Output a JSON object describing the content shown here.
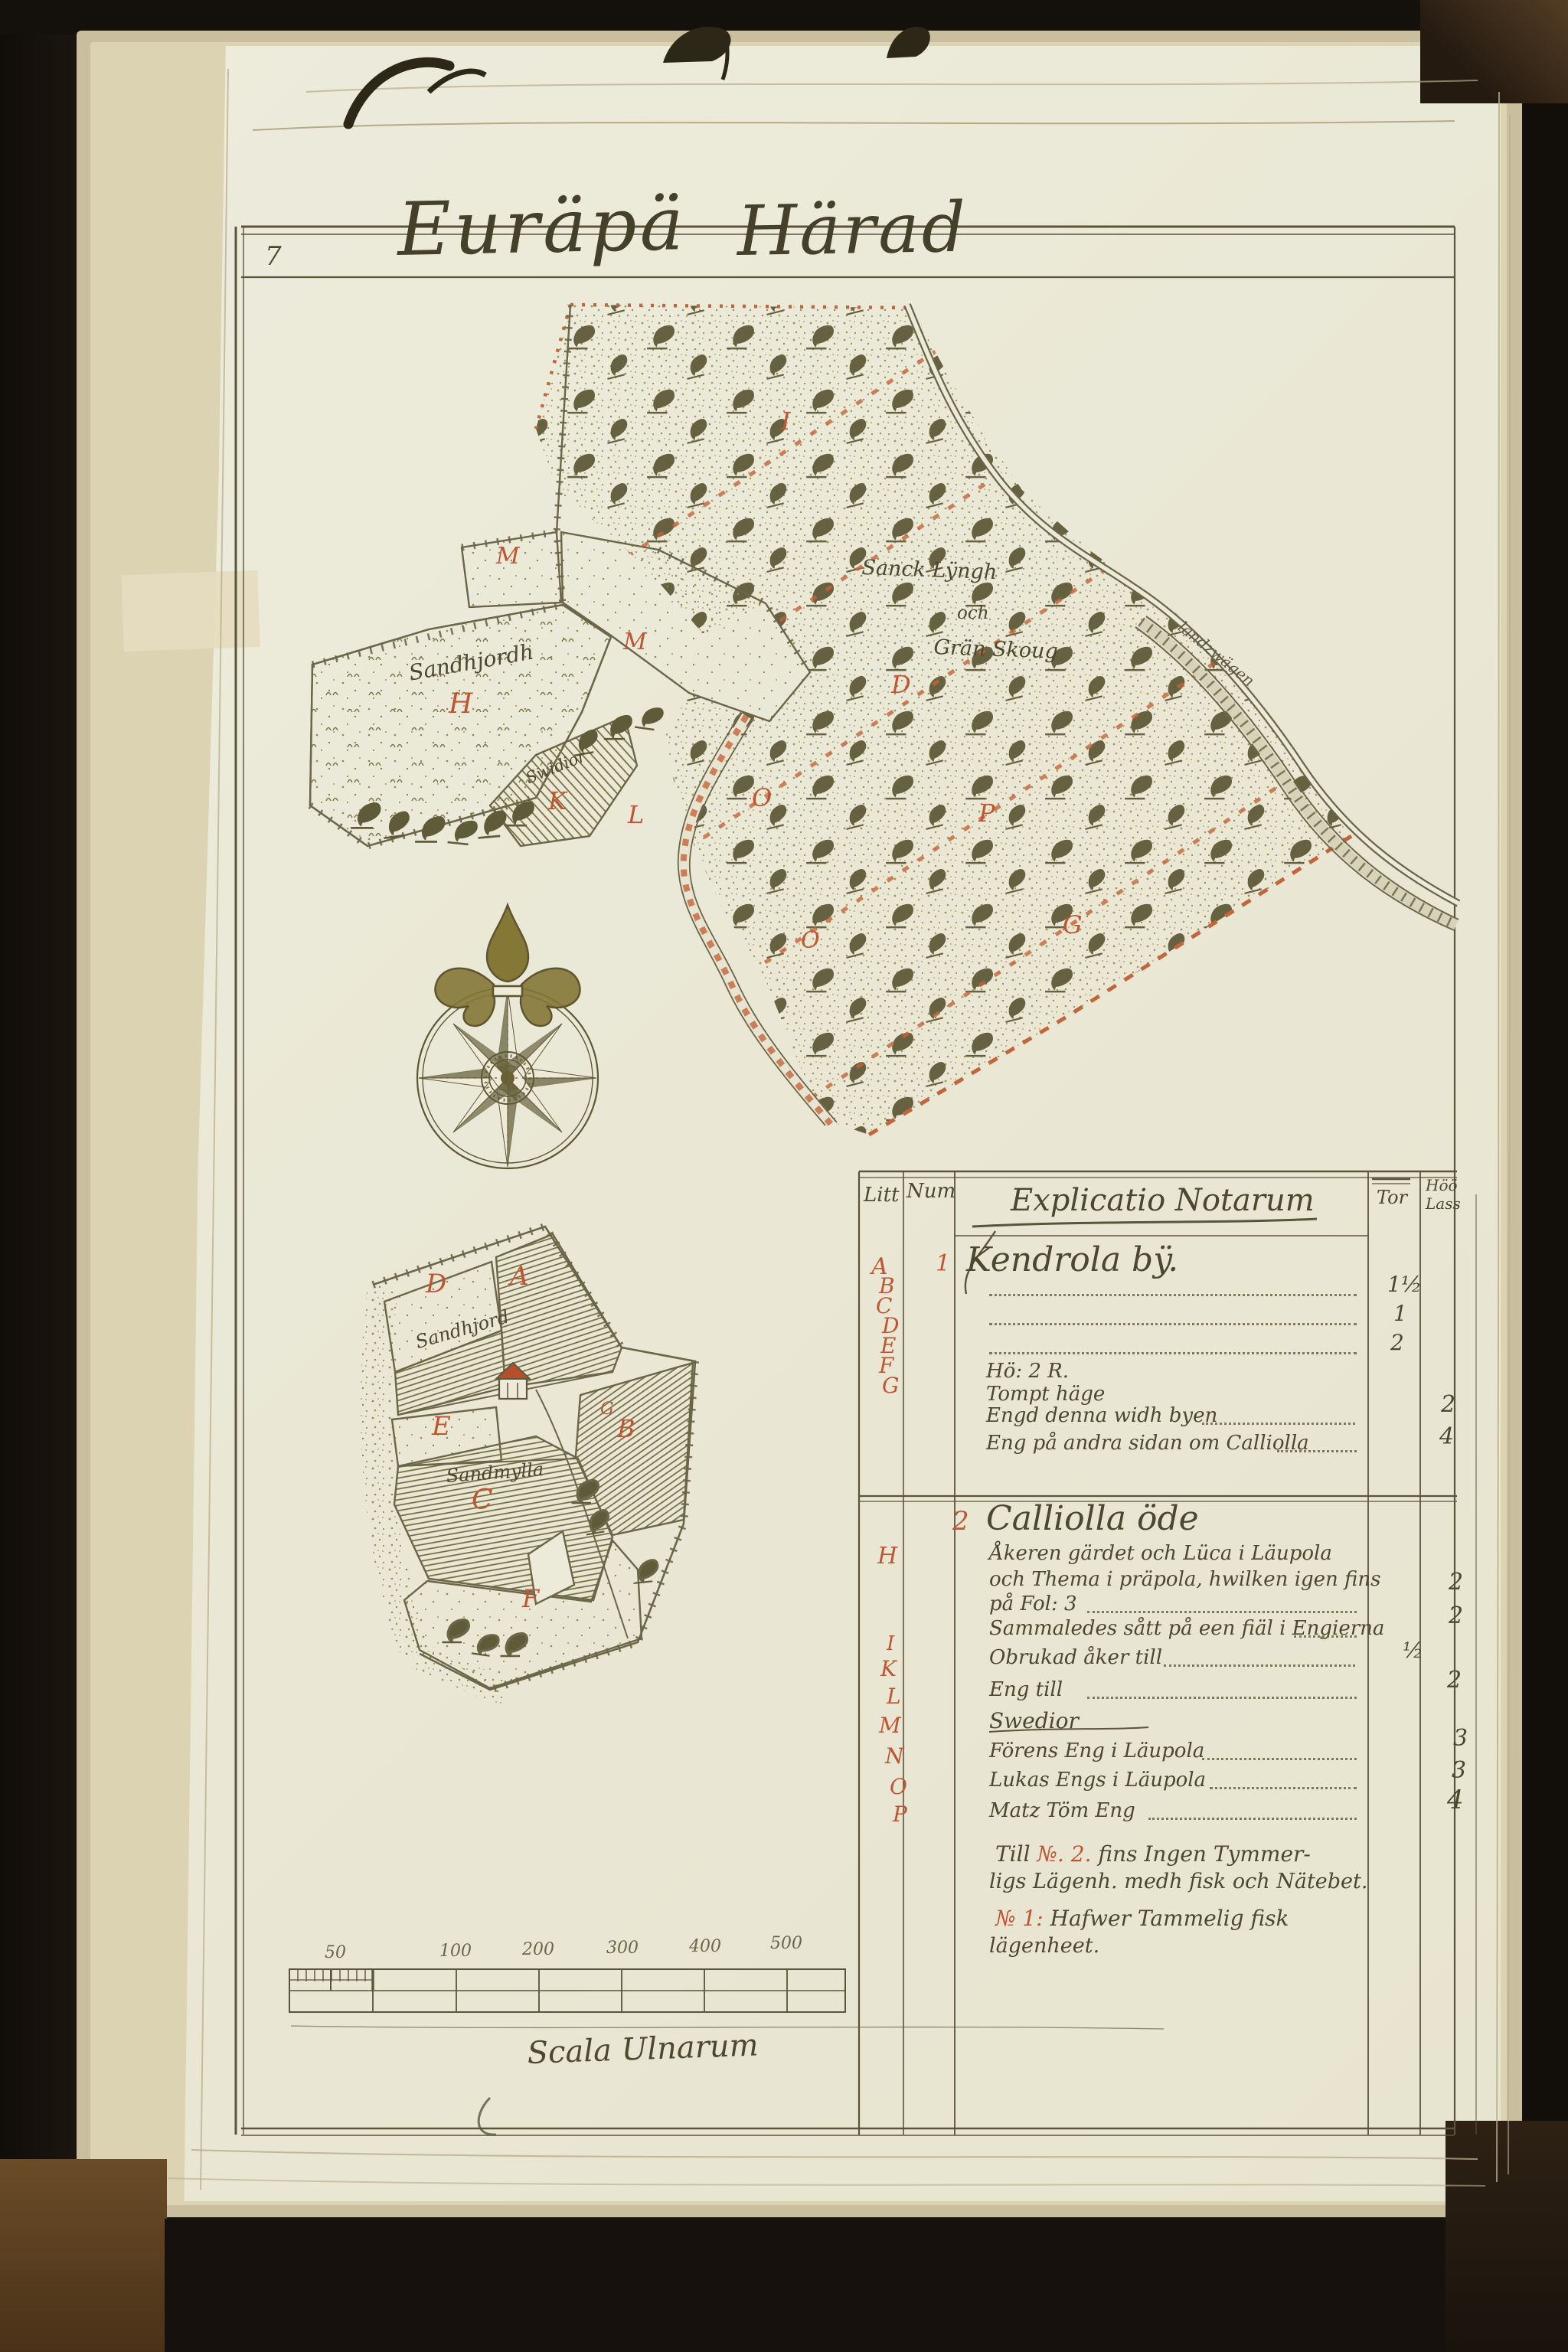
{
  "page": {
    "number": "7",
    "title_word1": "Euräpä",
    "title_word2": "Härad"
  },
  "map": {
    "labels": {
      "forest_text1": "Sanck Lÿngh",
      "forest_text2": "och",
      "forest_text3": "Grän Skoug",
      "road": "landzwägen",
      "field_h_text": "Sandhjordh",
      "wedge_text": "Swidior"
    },
    "letters": {
      "m1": "M",
      "m2": "M",
      "h": "H",
      "k": "K",
      "l": "L",
      "i": "I",
      "d": "D",
      "o1": "O",
      "p": "P",
      "g": "G",
      "o2": "O"
    }
  },
  "inset": {
    "letters": {
      "d": "D",
      "a": "A",
      "e": "E",
      "b": "B",
      "c": "C",
      "f": "F",
      "g": "G"
    },
    "texts": {
      "upper": "Sandhjord",
      "lower": "Sandmylla"
    }
  },
  "scalebar": {
    "labels": [
      "50",
      "100",
      "200",
      "300",
      "400",
      "500"
    ],
    "caption": "Scala Ulnarum"
  },
  "table": {
    "header": {
      "litt": "Litt",
      "num": "Num",
      "explicatio": "Explicatio Notarum",
      "col_tor": "Tor",
      "col_lass_1": "Höö",
      "col_lass_2": "Lass"
    },
    "section1": {
      "num": "1",
      "title": "Kendrola bÿ.",
      "litt": [
        "A",
        "B",
        "C",
        "D",
        "E",
        "F",
        "G"
      ],
      "row_a_tor": "1½",
      "row_b_tor": "1",
      "row_c_tor": "2",
      "row_d": "Hö: 2 R.",
      "row_e": "Tompt häge",
      "row_f": "Engd denna widh byen",
      "row_f_lass": "2",
      "row_g": "Eng på andra sidan om Calliolla",
      "row_g_lass": "4"
    },
    "section2": {
      "num": "2",
      "title": "Calliolla öde",
      "litt": [
        "H",
        "I",
        "K",
        "L",
        "M",
        "N",
        "O",
        "P"
      ],
      "row_h1": "Åkeren gärdet och Lüca i Läupola",
      "row_h2": "och Thema i präpola, hwilken igen fins",
      "row_h3": "på Fol: 3",
      "row_h3_lass": "2",
      "row_i": "Sammaledes sått på een fiäl i Engierna",
      "row_i_lass": "2",
      "row_k": "Obrukad åker till",
      "row_k_tor": "½",
      "row_l": "Eng till",
      "row_l_lass": "2",
      "row_m": "Swedior",
      "row_n": "Förens Eng i Läupola",
      "row_n_lass": "3",
      "row_o": "Lukas Engs i Läupola",
      "row_o_lass": "3",
      "row_p": "Matz Töm Eng",
      "row_p_lass": "4"
    },
    "footnotes": {
      "f1_pre": "Till ",
      "f1_no": "№. 2.",
      "f1_post": " fins Ingen Tymmer-",
      "f2": "ligs Lägenh. medh fisk och Nätebet.",
      "f3_no": "№ 1:",
      "f3_post": " Hafwer Tammelig fisk",
      "f4": "lägenheet."
    }
  }
}
